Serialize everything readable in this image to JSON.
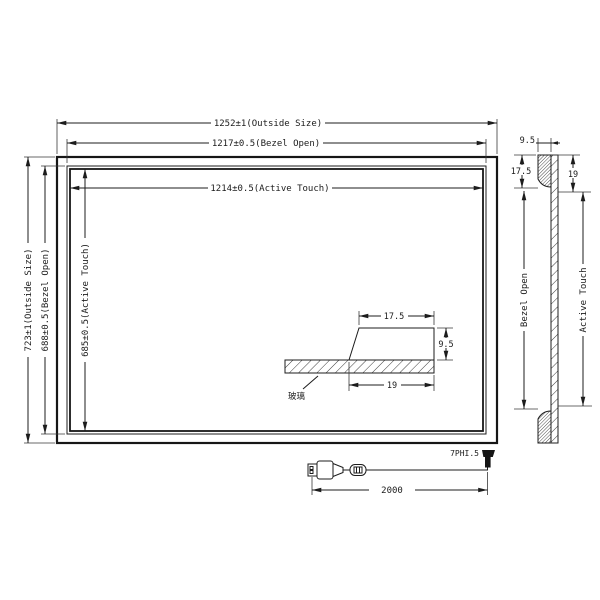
{
  "drawing": {
    "front_view": {
      "dim_outside_w": "1252±1(Outside Size)",
      "dim_bezel_w": "1217±0.5(Bezel Open)",
      "dim_active_w": "1214±0.5(Active Touch)",
      "dim_outside_h": "723±1(Outside Size)",
      "dim_bezel_h": "688±0.5(Bezel Open)",
      "dim_active_h": "685±0.5(Active Touch)"
    },
    "bezel_detail": {
      "dim_top": "17.5",
      "dim_height": "9.5",
      "dim_bottom": "19",
      "glass_label": "玻璃"
    },
    "side_section": {
      "dim_width": "9.5",
      "dim_left": "17.5",
      "dim_right": "19",
      "label_bezel": "Bezel Open",
      "label_active": "Active Touch"
    },
    "cable": {
      "connector_label": "7PHI.5",
      "dim_length": "2000"
    },
    "colors": {
      "line": "#1c1c1c",
      "background": "#ffffff"
    }
  }
}
